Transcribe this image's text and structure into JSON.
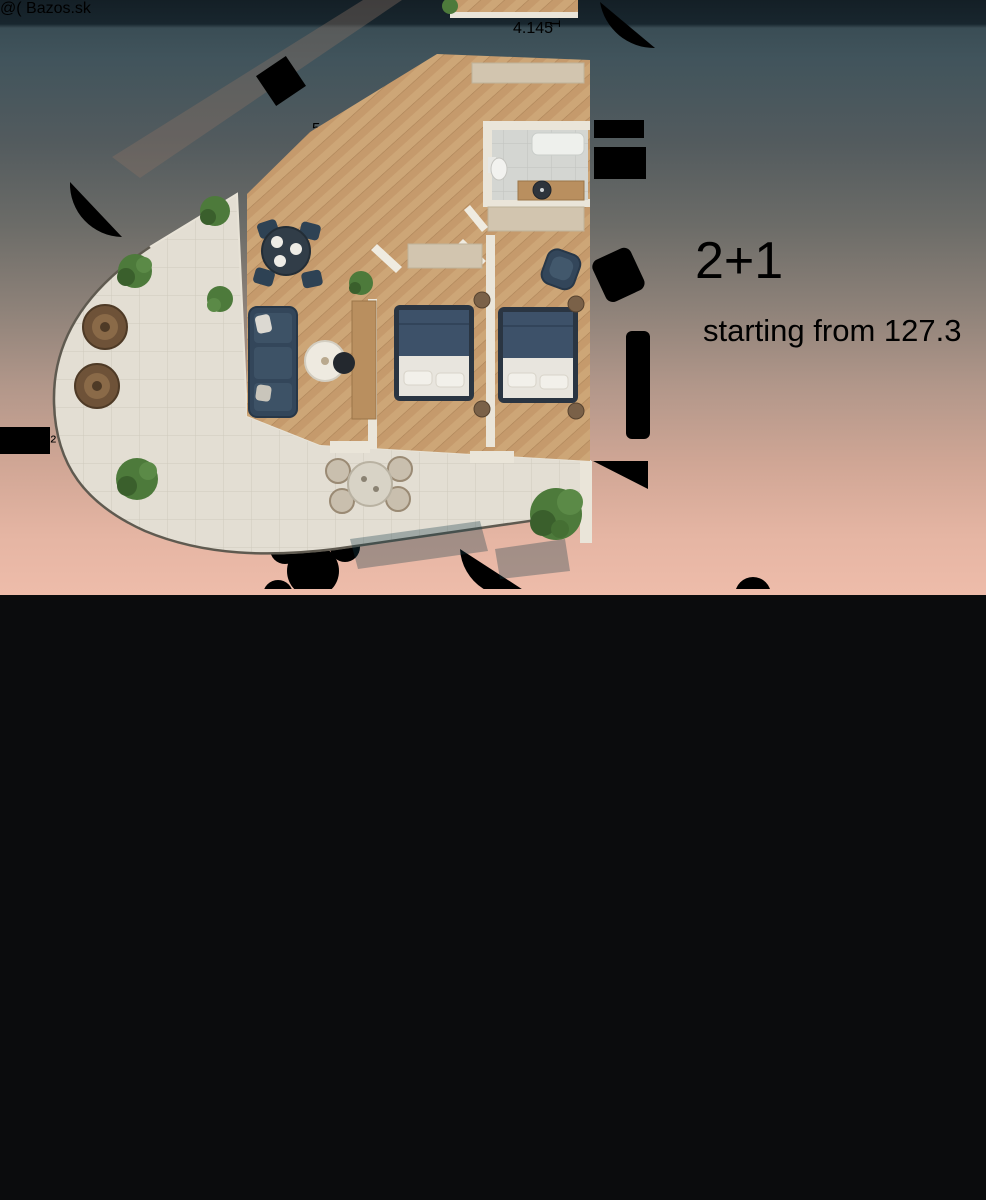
{
  "viewer": {
    "counter": "16 z 23",
    "watermark": "@( Bazos.sk",
    "badge_bg": "#e9eff1",
    "badge_text_color": "#5a666f"
  },
  "photo_top": {
    "unit_type": "2+1",
    "area_text": "starting from 82.6 m²",
    "dims": {
      "width_top": "1.800",
      "width_right": "2.700",
      "width_bottom": "9.100",
      "room_area": "13.6 m²",
      "vert_a": "800",
      "vert_b": "00"
    }
  },
  "photo_bottom": {
    "unit_type": "2+1",
    "area_text": "starting from 127.3",
    "dims": {
      "width_top": "4.145",
      "vert_a": "1.8",
      "diag": "5.5",
      "room_area": "3.7 m²"
    }
  }
}
